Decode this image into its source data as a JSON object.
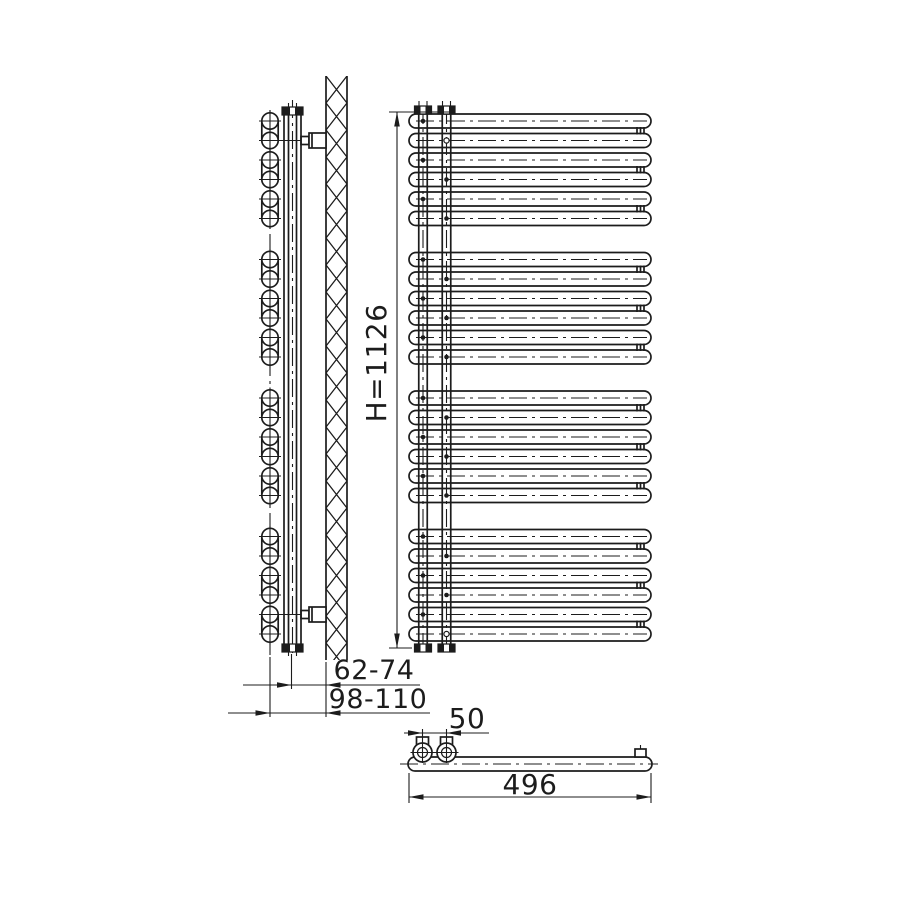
{
  "drawing": {
    "type": "technical-drawing",
    "subject": "towel-radiator-three-views",
    "labels": {
      "height": "H=1126",
      "wall_clearance_inner": "62-74",
      "wall_clearance_outer": "98-110",
      "tapping_spacing": "50",
      "width": "496"
    },
    "structure": {
      "tube_groups": 4,
      "tubes_per_group": 6,
      "tube_pairs_per_group": 3,
      "total_tubes": 24,
      "collector_pipes": 2,
      "wall_brackets": 2,
      "bottom_connections": 2
    },
    "colors": {
      "line": "#1c1c1c",
      "background": "#ffffff"
    }
  }
}
